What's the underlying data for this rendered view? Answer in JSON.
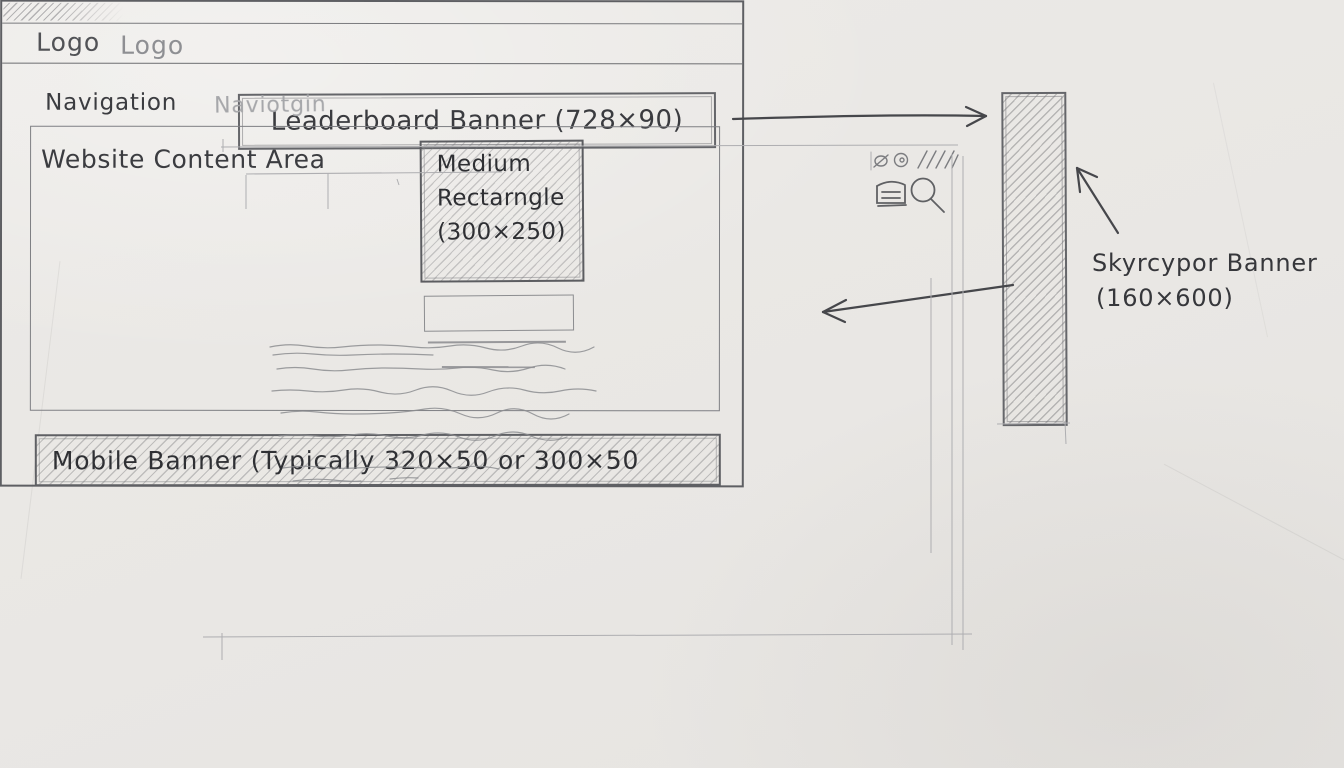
{
  "palette": {
    "paper": "#e9e7e4",
    "ink": "#3f4044",
    "ink_light": "#75767a",
    "ink_faded": "#a6a7aa",
    "hatch": "#b6b5b3"
  },
  "leaderboard_banner": {
    "label": "Leaderboard Banner (728×90)"
  },
  "skyscraper_banner": {
    "label": "Skyrcypor Banner",
    "size": "(160×600)"
  },
  "browser_window": {
    "header": {
      "logo_primary": "Logo",
      "logo_secondary": "Logo"
    },
    "nav": {
      "primary": "Navigation",
      "secondary": "Naviotgin"
    },
    "content": {
      "heading": "Website Content Area"
    },
    "medium_rectangle": {
      "lines": [
        "Medium",
        "Rectarngle",
        "(300×250)"
      ]
    },
    "mobile_banner": {
      "label": "Mobile Banner (Typically 320×50 or 300×50"
    }
  },
  "icons": {
    "search": "search-icon",
    "menu": "menu-icon",
    "window_controls": "window-control-icons"
  }
}
